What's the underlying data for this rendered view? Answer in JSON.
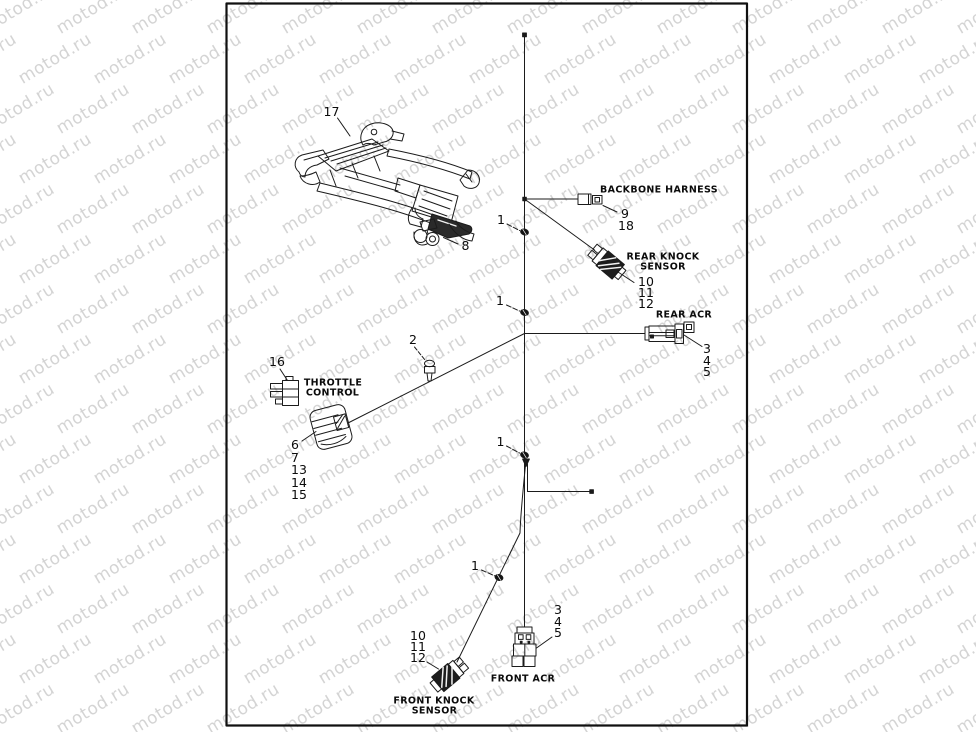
{
  "watermark": {
    "text": "motod.ru",
    "color": "#d4d4d4"
  },
  "diagram": {
    "line_color": "#1b1b1b",
    "frame_color": "#101010",
    "callouts": {
      "n1": "1",
      "n2": "2",
      "n3": "3",
      "n4": "4",
      "n5": "5",
      "n6": "6",
      "n7": "7",
      "n8": "8",
      "n9": "9",
      "n10": "10",
      "n11": "11",
      "n12": "12",
      "n13": "13",
      "n14": "14",
      "n15": "15",
      "n16": "16",
      "n17": "17",
      "n18": "18"
    },
    "components": {
      "backbone_harness": "BACKBONE HARNESS",
      "rear_knock_line1": "REAR KNOCK",
      "rear_knock_line2": "SENSOR",
      "rear_acr": "REAR ACR",
      "throttle_line1": "THROTTLE",
      "throttle_line2": "CONTROL",
      "front_acr": "FRONT ACR",
      "front_knock_line1": "FRONT KNOCK",
      "front_knock_line2": "SENSOR"
    }
  }
}
